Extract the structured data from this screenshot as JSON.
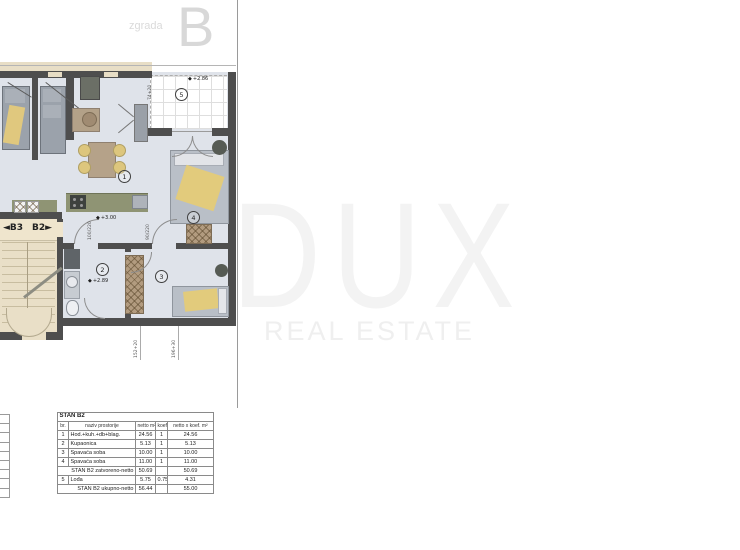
{
  "header": {
    "building_label": "zgrada",
    "building_letter": "B"
  },
  "watermark": {
    "title": "DUX",
    "subtitle": "REAL ESTATE"
  },
  "floorplan": {
    "marker_icon": "◆",
    "rooms": {
      "r1": "1",
      "r2": "2",
      "r3": "3",
      "r4": "4",
      "r5": "5"
    },
    "stairs": {
      "b3": "◄B3",
      "b2": "B2►"
    },
    "levels": {
      "hall": "+3.00",
      "bath": "+2.89",
      "loggia": "+2.86"
    },
    "dims": {
      "door_left": "100/220",
      "door_right": "90/220",
      "loggia_side": "74+20",
      "bottom_left": "152+20",
      "bottom_right": "196+30"
    }
  },
  "area_table": {
    "title": "STAN B2",
    "headers": {
      "br": "br.",
      "name": "naziv prostorije",
      "netto": "netto m²",
      "koef": "koef",
      "total": "netto x koef. m²"
    },
    "rows": [
      {
        "br": "1",
        "name": "Hod.+kuh.+db+blag.",
        "netto": "24.56",
        "koef": "1",
        "total": "24.56"
      },
      {
        "br": "2",
        "name": "Kupaonica",
        "netto": "5.13",
        "koef": "1",
        "total": "5.13"
      },
      {
        "br": "3",
        "name": "Spavaća soba",
        "netto": "10.00",
        "koef": "1",
        "total": "10.00"
      },
      {
        "br": "4",
        "name": "Spavaća soba",
        "netto": "11.00",
        "koef": "1",
        "total": "11.00"
      }
    ],
    "subtotal": {
      "label": "STAN B2 zatvoreno-netto",
      "netto": "50.69",
      "total": "50.69"
    },
    "row5": {
      "br": "5",
      "name": "Lođa",
      "netto": "5.75",
      "koef": "0.75",
      "total": "4.31"
    },
    "grand_total": {
      "label": "STAN B2 ukupno-netto",
      "netto": "56.44",
      "total": "55.00"
    }
  }
}
